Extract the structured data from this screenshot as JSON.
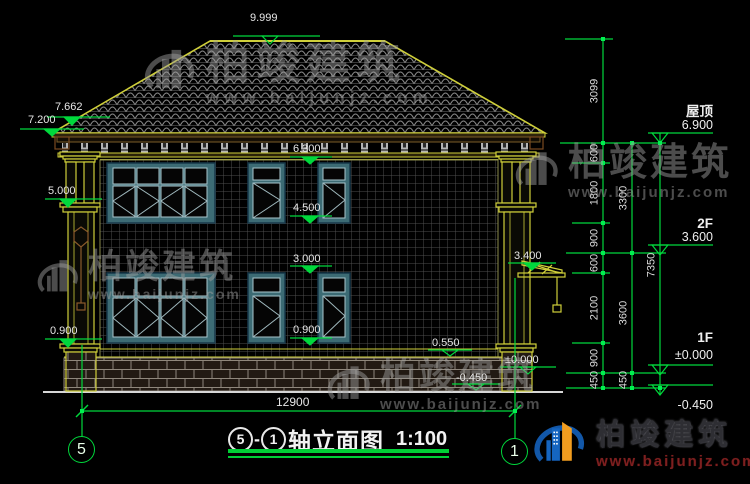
{
  "watermark": {
    "brand": "柏竣建筑",
    "url": "www.baijunjz.com"
  },
  "title": {
    "axis_start": "5",
    "separator": "-",
    "axis_end": "1",
    "text": "轴立面图",
    "scale": "1:100"
  },
  "axis_bubbles": {
    "left": "5",
    "right": "1"
  },
  "elevation_markers": {
    "ridge": "9.999",
    "roof_upper": "7.662",
    "eave": "7.200",
    "col_capital": "5.000",
    "col_base_left": "0.900",
    "win2_top": "6.300",
    "win2_sill": "4.500",
    "win1_top": "3.000",
    "win1_sill": "0.900",
    "canopy": "3.400",
    "plinth": "0.550",
    "zero": "±0.000",
    "minus": "-0.450"
  },
  "right_levels": {
    "roof_name": "屋顶",
    "roof_value": "6.900",
    "f2_name": "2F",
    "f2_value": "3.600",
    "f1_name": "1F",
    "f1_value": "±0.000",
    "below_value": "-0.450"
  },
  "dim_col1": [
    "3099",
    "600",
    "1800",
    "900",
    "600",
    "2100",
    "900",
    "450"
  ],
  "dim_col2": [
    "3300",
    "3600",
    "450"
  ],
  "dim_col3": [
    "7350"
  ],
  "dim_overall": "12900",
  "colors": {
    "background": "#000000",
    "dimension_green": "#00d83c",
    "outline_yellow": "#cfcf3a",
    "window_teal": "#3c6b74",
    "text_white": "#e6e6e6",
    "logo_blue": "#1565c0",
    "logo_orange": "#f29d1f",
    "url_red": "#7d1f1f",
    "watermark_gray": "#9e9e9e"
  }
}
